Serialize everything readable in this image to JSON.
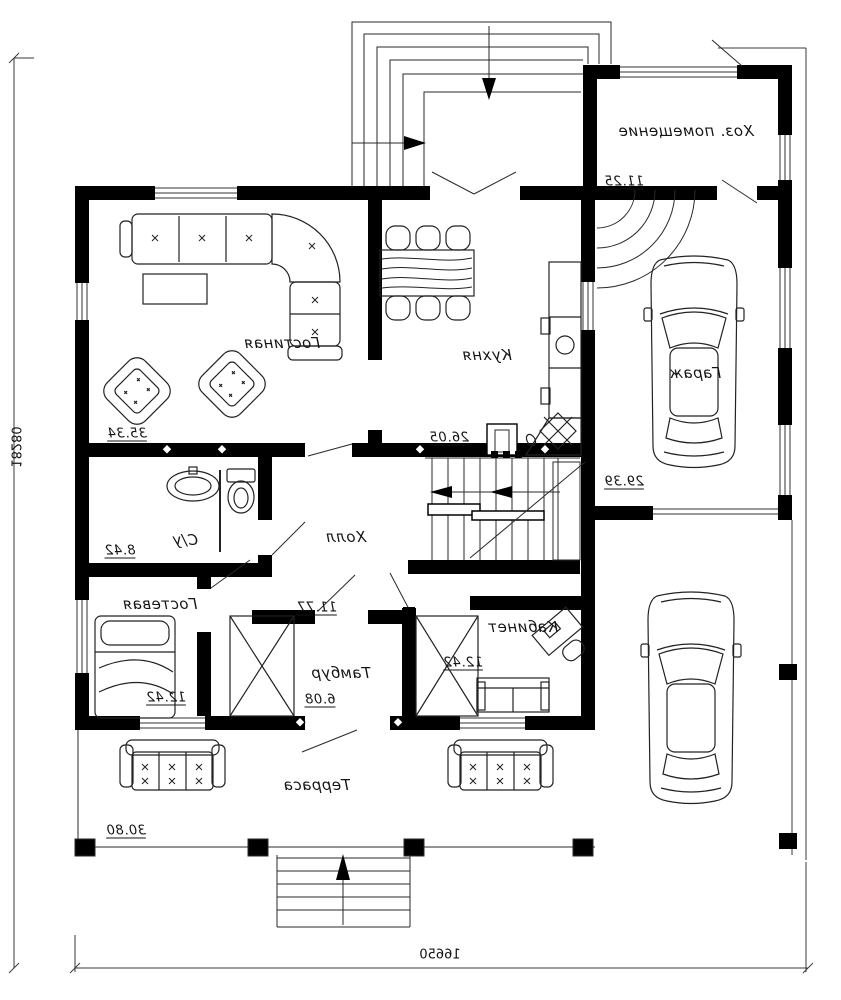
{
  "plan": {
    "rooms": [
      {
        "label": "Гостиная",
        "area": "35.34"
      },
      {
        "label": "Кухня",
        "area": "26.05"
      },
      {
        "label": "Холл",
        "area": "11.77"
      },
      {
        "label": "С/у",
        "area": "8.42"
      },
      {
        "label": "Гостевая",
        "area": "12.42"
      },
      {
        "label": "Тамбур",
        "area": "6.08"
      },
      {
        "label": "Кабинет",
        "area": "12.42"
      },
      {
        "label": "Терраса",
        "area": "30.80"
      },
      {
        "label": "Гараж",
        "area": "29.39"
      },
      {
        "label": "Хоз. помещение",
        "area": "11.25"
      }
    ],
    "dimensions": {
      "overall_width_mm": "16650",
      "overall_height_mm": "18280"
    },
    "colors": {
      "wall": "#000000",
      "line": "#222222",
      "background": "#ffffff"
    }
  }
}
